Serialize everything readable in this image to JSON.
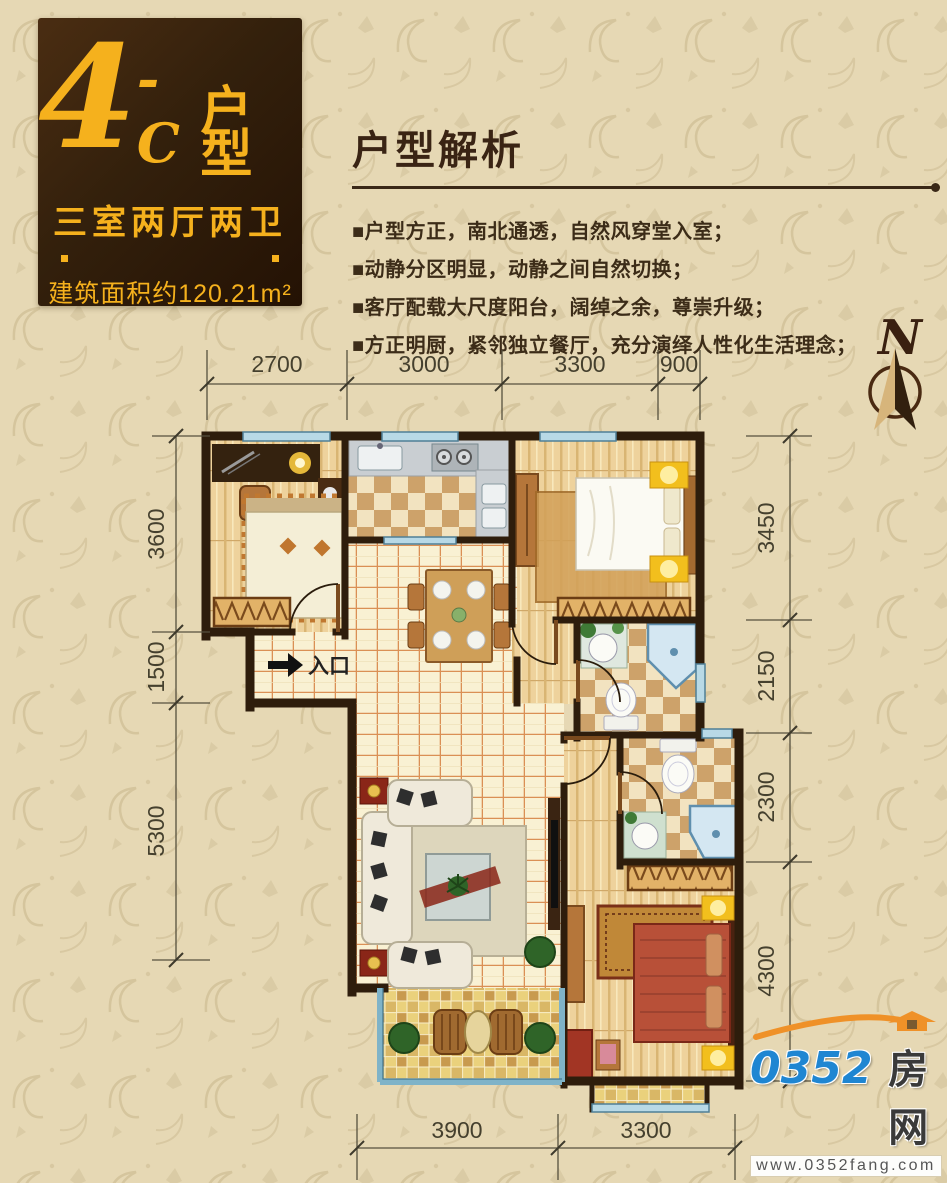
{
  "badge": {
    "unit_big": "4",
    "unit_dash": "-C",
    "unit_label": "户型",
    "rooms_line": "三室两厅两卫",
    "area_line": "建筑面积约120.21m²"
  },
  "analysis": {
    "title": "户型解析",
    "bullets": [
      "■户型方正，南北通透，自然风穿堂入室；",
      "■动静分区明显，动静之间自然切换；",
      "■客厅配载大尺度阳台，阔绰之余，尊崇升级；",
      "■方正明厨，紧邻独立餐厅，充分演绎人性化生活理念；"
    ]
  },
  "compass": {
    "label": "N"
  },
  "floor_plan": {
    "entrance_label": "入口",
    "dimensions": {
      "top": [
        "2700",
        "3000",
        "3300",
        "900"
      ],
      "left": [
        "3600",
        "1500",
        "5300"
      ],
      "right": [
        "3450",
        "2150",
        "2300",
        "4300"
      ],
      "bottom": [
        "3900",
        "3300"
      ]
    }
  },
  "logo": {
    "number": "0352",
    "cn": "房网",
    "url": "www.0352fang.com"
  },
  "colors": {
    "background": "#e6d8b4",
    "badge_brown": "#33200c",
    "accent_gold": "#f5b11d",
    "text_brown": "#3c2c18",
    "wall": "#2e1d0c",
    "window_blue": "#b8d9e6",
    "logo_blue": "#1f86d2",
    "logo_orange": "#ef9128"
  }
}
